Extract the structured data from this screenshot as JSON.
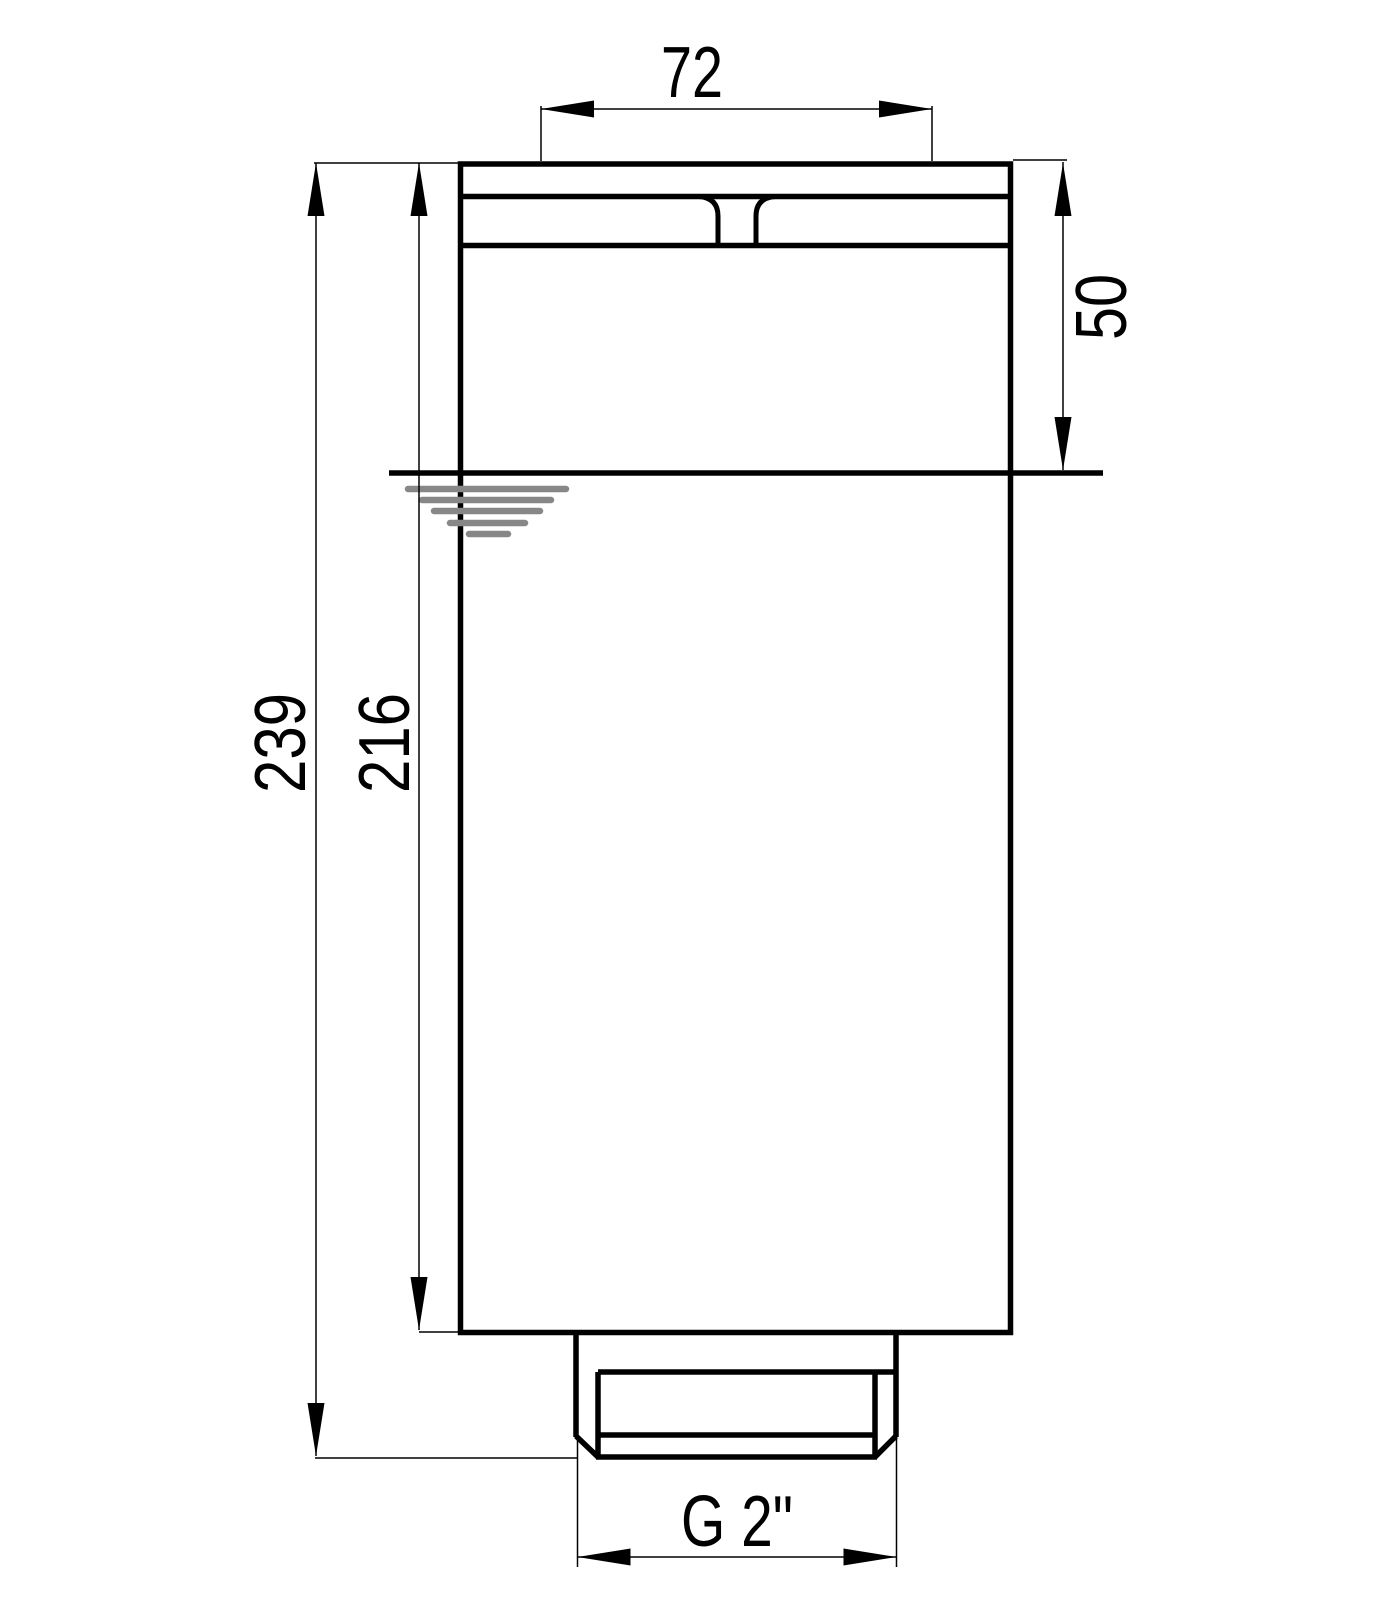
{
  "colors": {
    "line": "#000000",
    "water_symbol": "#878787",
    "background": "#ffffff"
  },
  "dimensions": {
    "top_width": "72",
    "head_height": "50",
    "overall_height": "239",
    "body_height": "216",
    "thread_size": "G 2\""
  }
}
